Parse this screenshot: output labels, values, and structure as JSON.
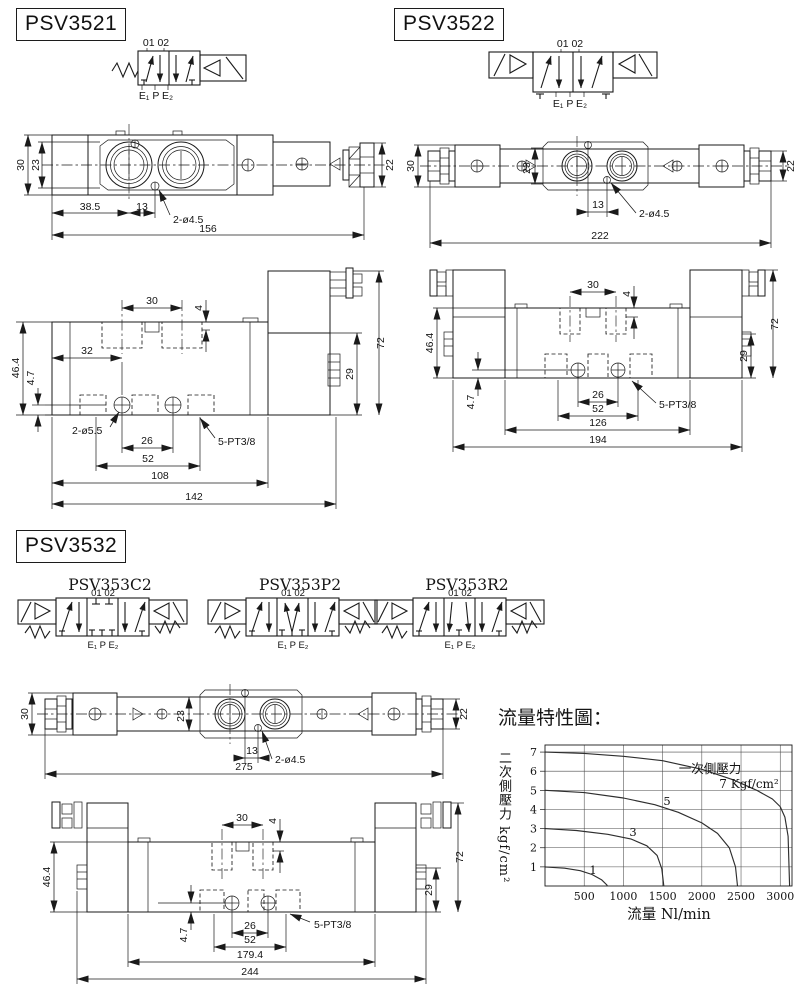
{
  "page": {
    "background": "#ffffff",
    "line_color": "#1a1a1a"
  },
  "ports": {
    "top": "01 02",
    "bottom": "E₁ P E₂"
  },
  "psv3521": {
    "title": "PSV3521",
    "top_view": {
      "height": "30",
      "inner_height": "23",
      "port1_offset": "38.5",
      "hole_offset": "13",
      "holes_label": "2-ø4.5",
      "total_length": "156",
      "end_height": "22"
    },
    "front_view": {
      "slot_pitch": "30",
      "slot_depth": "4",
      "body_height": "46.4",
      "hole_drop": "4.7",
      "hole1_offset": "32",
      "holes_label": "2-ø5.5",
      "port_pitch": "26",
      "port_span": "52",
      "body_length": "108",
      "total_length": "142",
      "coil_height": "29",
      "total_height": "72",
      "ports_label": "5-PT3/8"
    }
  },
  "psv3522": {
    "title": "PSV3522",
    "top_view": {
      "height": "30",
      "inner_height": "23",
      "hole_offset": "13",
      "holes_label": "2-ø4.5",
      "total_length": "222",
      "end_height": "22"
    },
    "front_view": {
      "slot_pitch": "30",
      "slot_depth": "4",
      "body_height": "46.4",
      "hole_drop": "4.7",
      "port_pitch": "26",
      "port_span": "52",
      "body_length": "126",
      "total_length": "194",
      "coil_height": "29",
      "total_height": "72",
      "ports_label": "5-PT3/8"
    }
  },
  "psv3532": {
    "title": "PSV3532",
    "variants": [
      "PSV353C2",
      "PSV353P2",
      "PSV353R2"
    ],
    "top_view": {
      "height": "30",
      "inner_height": "23",
      "hole_offset": "13",
      "holes_label": "2-ø4.5",
      "total_length": "275",
      "end_height": "22"
    },
    "front_view": {
      "slot_pitch": "30",
      "slot_depth": "4",
      "body_height": "46.4",
      "hole_drop": "4.7",
      "port_pitch": "26",
      "port_span": "52",
      "body_length": "179.4",
      "total_length": "244",
      "coil_height": "29",
      "total_height": "72",
      "ports_label": "5-PT3/8"
    }
  },
  "chart": {
    "title": "流量特性圖：",
    "y_axis_label": "二次側壓力 kgf/cm²",
    "x_axis_label": "流量 Nl/min",
    "legend_title": "一次側壓力",
    "legend_value": "7 Kgf/cm²",
    "curve_labels": [
      "5",
      "3",
      "1"
    ]
  },
  "chart_data": {
    "type": "line",
    "title": "流量特性圖",
    "xlabel": "流量 Nl/min",
    "ylabel": "二次側壓力 kgf/cm²",
    "xlim": [
      0,
      3150
    ],
    "ylim": [
      0,
      7.37
    ],
    "x_ticks": [
      500,
      1000,
      1500,
      2000,
      2500,
      3000
    ],
    "y_ticks": [
      1,
      2,
      3,
      4,
      5,
      6,
      7
    ],
    "grid": true,
    "legend": {
      "title": "一次側壓力",
      "label": "7 Kgf/cm²",
      "position": "top-right"
    },
    "series": [
      {
        "name": "7",
        "points": [
          [
            0,
            7
          ],
          [
            500,
            6.93
          ],
          [
            1000,
            6.78
          ],
          [
            1500,
            6.55
          ],
          [
            2000,
            6.1
          ],
          [
            2400,
            5.55
          ],
          [
            2700,
            5.0
          ],
          [
            2900,
            4.55
          ],
          [
            3000,
            4.15
          ],
          [
            3060,
            3.6
          ],
          [
            3100,
            2.6
          ],
          [
            3120,
            0
          ]
        ]
      },
      {
        "name": "5",
        "points": [
          [
            0,
            5
          ],
          [
            500,
            4.88
          ],
          [
            1000,
            4.6
          ],
          [
            1400,
            4.25
          ],
          [
            1700,
            3.85
          ],
          [
            2000,
            3.3
          ],
          [
            2200,
            2.75
          ],
          [
            2350,
            2.0
          ],
          [
            2430,
            1.0
          ],
          [
            2455,
            0
          ]
        ]
      },
      {
        "name": "3",
        "points": [
          [
            0,
            3
          ],
          [
            400,
            2.9
          ],
          [
            800,
            2.7
          ],
          [
            1100,
            2.45
          ],
          [
            1300,
            2.1
          ],
          [
            1430,
            1.6
          ],
          [
            1490,
            0.9
          ],
          [
            1515,
            0
          ]
        ]
      },
      {
        "name": "1",
        "points": [
          [
            0,
            1
          ],
          [
            250,
            0.93
          ],
          [
            450,
            0.8
          ],
          [
            600,
            0.6
          ],
          [
            720,
            0.33
          ],
          [
            790,
            0.05
          ],
          [
            795,
            0
          ]
        ]
      }
    ]
  }
}
